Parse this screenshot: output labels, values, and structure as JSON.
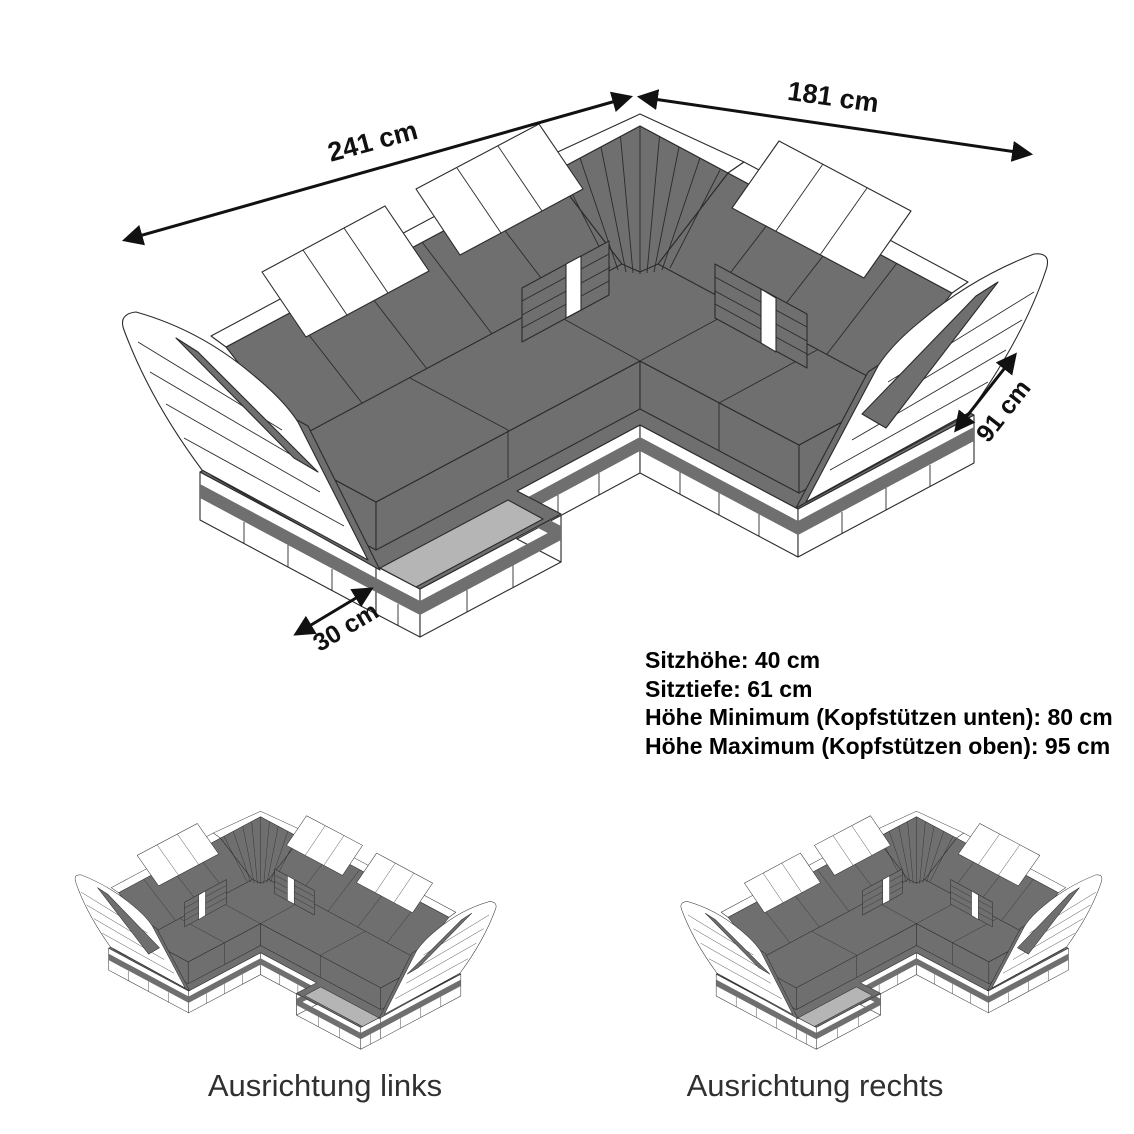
{
  "diagram": {
    "title_hidden": "",
    "dimensions": {
      "long_side": "241 cm",
      "short_side": "181 cm",
      "depth": "91 cm",
      "base_platform": "30 cm"
    },
    "specs": {
      "line1": "Sitzhöhe: 40 cm",
      "line2": "Sitztiefe: 61 cm",
      "line3": "Höhe Minimum (Kopfstützen unten): 80 cm",
      "line4": "Höhe Maximum (Kopfstützen oben): 95 cm"
    },
    "variants": {
      "left_label": "Ausrichtung links",
      "right_label": "Ausrichtung rechts"
    },
    "colors": {
      "upholstery_dark": "#6f6f6f",
      "upholstery_white": "#ffffff",
      "base_inset_light": "#b5b5b5",
      "outline": "#2b2b2b",
      "dimension_text": "#111111",
      "variant_label_text": "#303030",
      "background": "#ffffff"
    }
  }
}
